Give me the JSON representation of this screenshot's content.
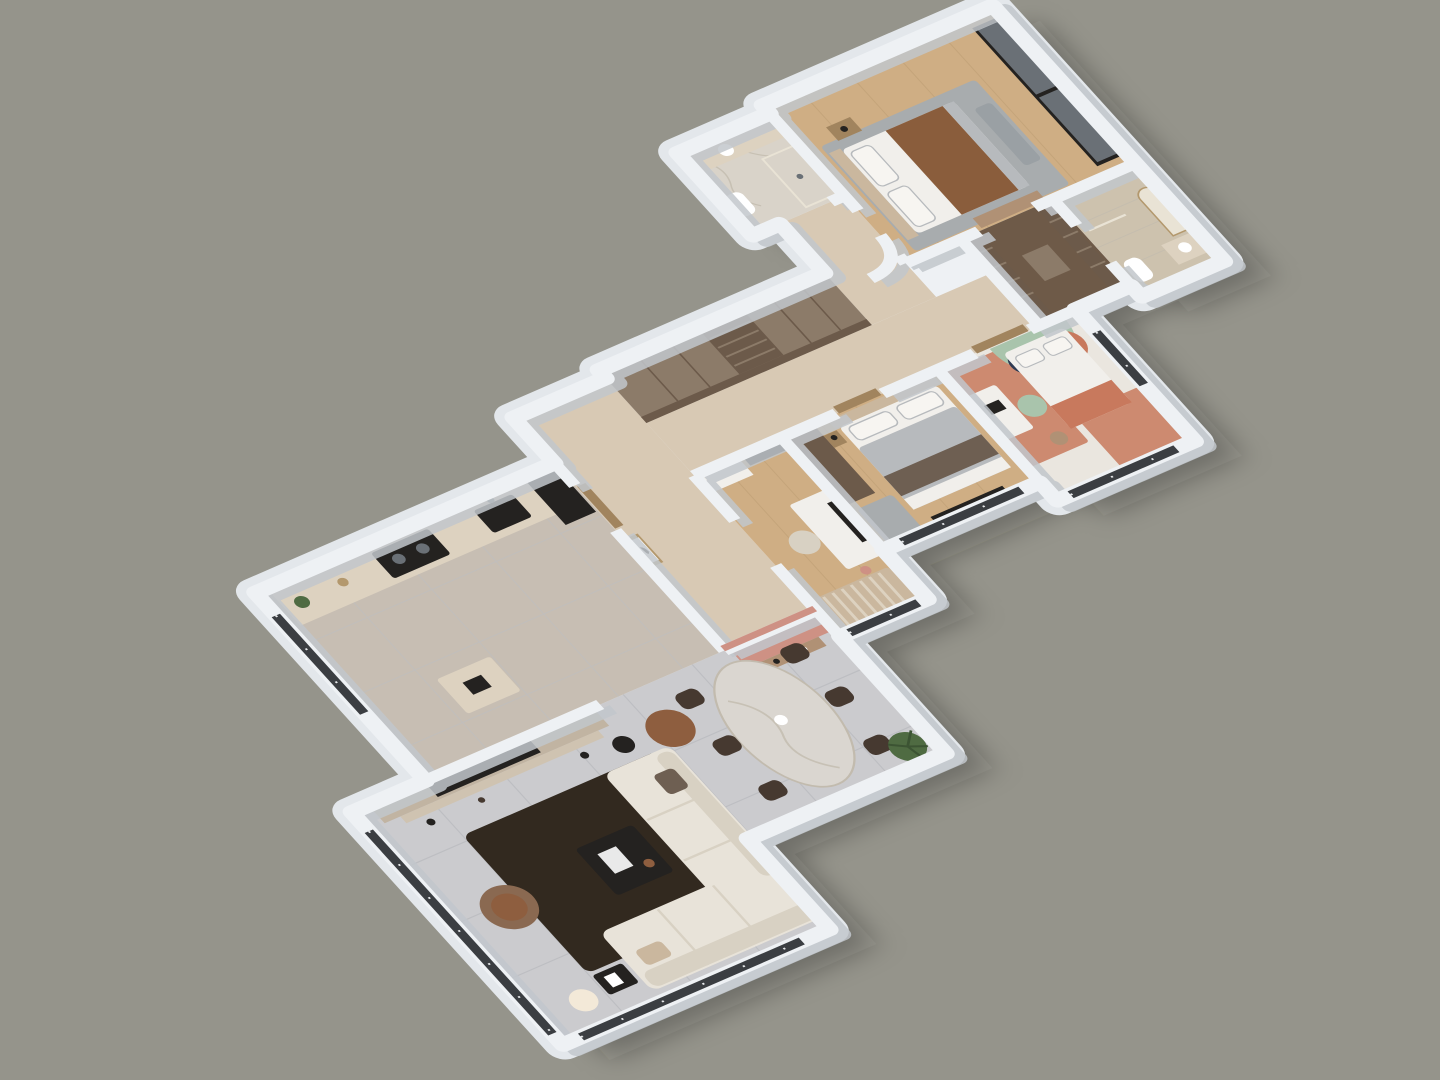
{
  "scene": {
    "title": "3D apartment floor plan render",
    "view": "axonometric cutaway, rotated diagonal, olive-gray studio backdrop",
    "canvas": {
      "width": 1440,
      "height": 1080
    }
  },
  "palette": {
    "bg": "#95948b",
    "shadow": "rgba(25,25,20,0.32)",
    "wallTop": "#eef1f4",
    "wallFace": "#c2c7cc",
    "plinth": "#e3e7eb",
    "glass": "#3b3e42",
    "glassLight": "#6a7076",
    "mullion": "#e8eaec",
    "livingFloor": "#cbcbce",
    "tileLine": "#bdbec2",
    "kitchenFloor": "#c7beb3",
    "woodFloor": "#cfae84",
    "woodLine": "#bb9d73",
    "hallFloor": "#d8c9b4",
    "kidsFloor": "#eae6df",
    "marble": "#d9d3c9",
    "marbleVein": "#c2bbae",
    "travertine": "#cdc2ae",
    "closetFloor": "#6e5a48",
    "counter": "#ddd2c0",
    "tvPanel": "#c1b4a2",
    "tvShelf": "#cfc3b1",
    "dark": "#242220",
    "rugDark": "#32291f",
    "sofa": "#e8e3d9",
    "sofaShade": "#d8d1c3",
    "armBrown": "#8a6951",
    "pouf": "#8e5e3f",
    "marbleTable": "#dad6d0",
    "chairDark": "#463930",
    "blushWall": "#ce9184",
    "consoleWood": "#b09175",
    "wardrobeTop": "#8c7b69",
    "wardrobeFront": "#6c5a4a",
    "doorWood": "#a1845e",
    "mint": "#a9c4ac",
    "navy": "#2e3a52",
    "terracotta": "#c8795d",
    "terraMat": "#cd8a70",
    "bedWhite": "#f1efeb",
    "pillow": "#f7f5f1",
    "duvetGray": "#b7babd",
    "duvetBrown": "#6e5f52",
    "masterBlanket": "#8a5d3c",
    "headboard": "#cab79e",
    "rugGray": "#a8acae",
    "mirror": "#e9e3d5",
    "plant": "#4f6b42",
    "plantDark": "#3c5433",
    "gold": "#b3986d",
    "white": "#ffffff",
    "benchGray": "#9aa0a4",
    "lampGlow": "#f3e9d8"
  },
  "rooms": {
    "living": {
      "label": "Living room",
      "items": [
        "cream L-shaped sofa",
        "dark brown area rug",
        "black coffee table",
        "brown swivel armchair",
        "globe floor lamp",
        "TV media wall"
      ]
    },
    "dining": {
      "label": "Dining area",
      "items": [
        "oval marble dining table",
        "six dark upholstered chairs",
        "blush console wall",
        "potted palm plant"
      ]
    },
    "kitchen": {
      "label": "Kitchen",
      "items": [
        "beige stone counter",
        "black sink",
        "black cooktop",
        "tall dark fridge unit",
        "small prep table",
        "window"
      ]
    },
    "hall": {
      "label": "Entry hall",
      "items": [
        "framed bird artwork",
        "wood floor",
        "entry door"
      ]
    },
    "corridor": {
      "label": "Corridor",
      "items": [
        "long built-in wardrobe with shelves"
      ]
    },
    "study": {
      "label": "Study",
      "items": [
        "white desk with monitor",
        "striped rug",
        "wall cabinet"
      ]
    },
    "bedroom2": {
      "label": "Bedroom",
      "items": [
        "double bed with gray and brown bedding",
        "panel headboard",
        "wardrobe",
        "nightstand"
      ]
    },
    "kids": {
      "label": "Kids bedroom",
      "items": [
        "bed with mint arch headboard",
        "navy and terracotta wall circles",
        "terracotta floor mats",
        "white desk",
        "mint chair"
      ]
    },
    "master": {
      "label": "Master bedroom",
      "items": [
        "bed with brown blanket",
        "gray rug",
        "black-framed glass sliding wardrobe",
        "foot bench",
        "curved corner wall"
      ]
    },
    "masterBath": {
      "label": "Master bathroom",
      "items": [
        "marble vanity",
        "round mirror",
        "toilet",
        "shower"
      ]
    },
    "closet": {
      "label": "Walk-in closet",
      "items": [
        "dark wood shelving"
      ]
    },
    "bath2": {
      "label": "Second bathroom",
      "items": [
        "arched mirror niche",
        "travertine walls",
        "vanity",
        "toilet"
      ]
    }
  }
}
